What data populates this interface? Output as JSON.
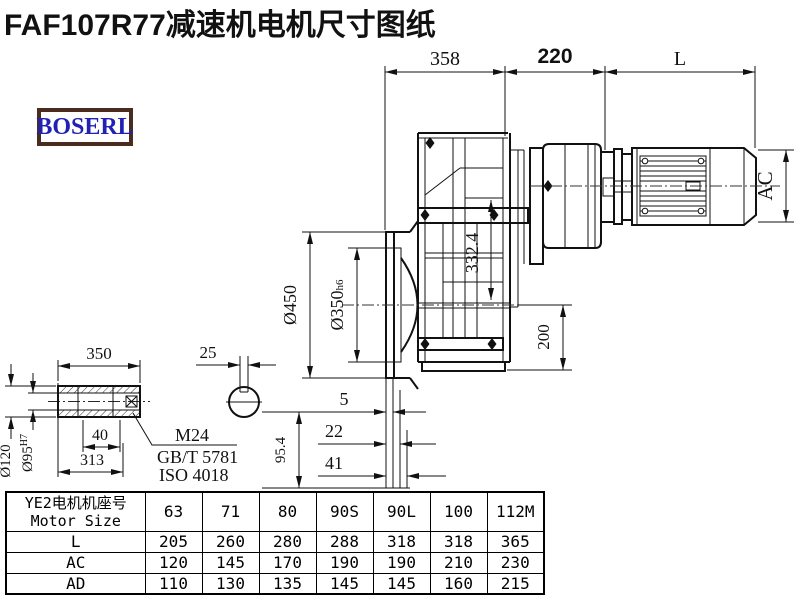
{
  "title": "FAF107R77减速机电机尺寸图纸",
  "logo": {
    "text": "BOSERL",
    "border_color": "#4a2b20",
    "text_color": "#2121b5"
  },
  "drawing": {
    "dim_top_1": "358",
    "dim_top_2": "220",
    "dim_top_3": "L",
    "dim_motor_diameter": "AC",
    "dim_center_height": "332.4",
    "dim_flange_diameter": "Ø450",
    "dim_spigot_diameter": "Ø350",
    "dim_spigot_tolerance": "h6",
    "dim_foot_height": "200",
    "dim_face_offset_1": "5",
    "dim_face_offset_2": "22",
    "dim_face_offset_3": "41",
    "dim_base_height": "95.4",
    "shaft": {
      "dim_length": "350",
      "dim_hub_length": "313",
      "dim_key_depth": "40",
      "dim_outer_diameter": "Ø120",
      "dim_bore_diameter": "Ø95",
      "bore_tolerance": "H7",
      "dim_keyway_width": "25",
      "thread_label": "M24",
      "standard_1": "GB/T 5781",
      "standard_2": "ISO 4018"
    }
  },
  "table": {
    "header_cn": "YE2电机机座号",
    "header_en": "Motor Size",
    "columns": [
      "63",
      "71",
      "80",
      "90S",
      "90L",
      "100",
      "112M"
    ],
    "rows": [
      {
        "label": "L",
        "values": [
          "205",
          "260",
          "280",
          "288",
          "318",
          "318",
          "365"
        ]
      },
      {
        "label": "AC",
        "values": [
          "120",
          "145",
          "170",
          "190",
          "190",
          "210",
          "230"
        ]
      },
      {
        "label": "AD",
        "values": [
          "110",
          "130",
          "135",
          "145",
          "145",
          "160",
          "215"
        ]
      }
    ]
  }
}
